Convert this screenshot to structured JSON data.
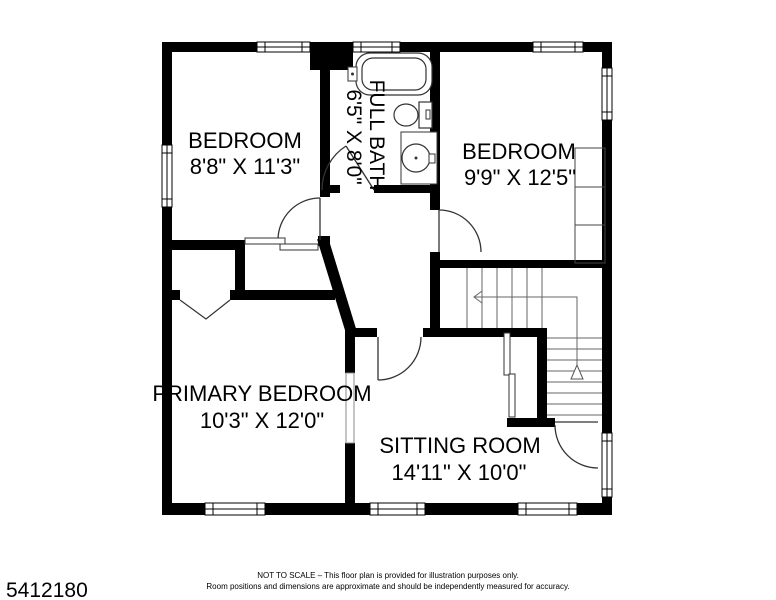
{
  "plan": {
    "rooms": [
      {
        "id": "bedroom-top-left",
        "name": "BEDROOM",
        "dims": "8'8\" X 11'3\""
      },
      {
        "id": "full-bath",
        "name": "FULL BATH",
        "dims": "6'5\" X 8'0\""
      },
      {
        "id": "bedroom-top-right",
        "name": "BEDROOM",
        "dims": "9'9\" X 12'5\""
      },
      {
        "id": "primary-bedroom",
        "name": "PRIMARY BEDROOM",
        "dims": "10'3\" X 12'0\""
      },
      {
        "id": "sitting-room",
        "name": "SITTING ROOM",
        "dims": "14'11\" X 10'0\""
      }
    ]
  },
  "footer": {
    "listing_id": "5412180",
    "disclaimer_line1": "NOT TO SCALE – This floor plan is provided for illustration purposes only.",
    "disclaimer_line2": "Room positions and dimensions are approximate and should be independently measured for accuracy."
  },
  "colors": {
    "wall": "#000000",
    "background": "#ffffff",
    "thin_line": "#444444"
  }
}
